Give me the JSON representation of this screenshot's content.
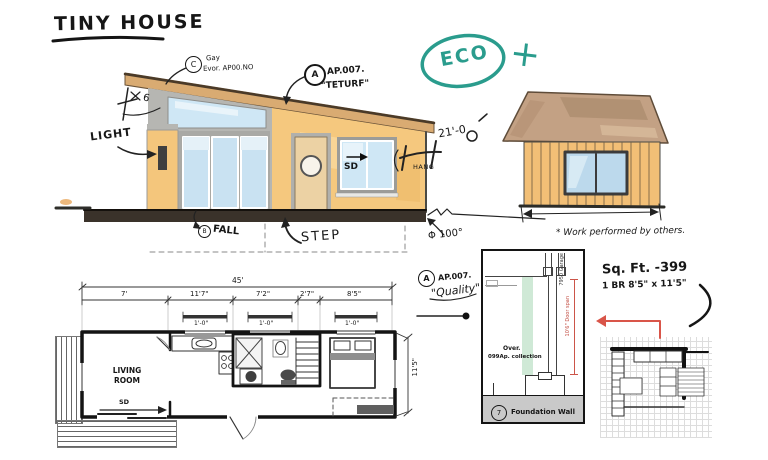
{
  "title": "TINY HOUSE",
  "eco": {
    "label": "ECO",
    "plus": "+"
  },
  "elevation": {
    "note_c": {
      "bubble": "C",
      "line1": "Gay",
      "line2": "Evor. AP00.NO"
    },
    "note_a": {
      "bubble": "A",
      "line1": "AP.007.",
      "line2": "\"TETURF\""
    },
    "light": "LIGHT",
    "slope_mark": "6",
    "fall_bubble": "B",
    "fall": "FALL",
    "step": "STEP",
    "sd": "SD",
    "hang": "HANG",
    "height": "21'-0",
    "angle": "Φ 100°"
  },
  "gable": {
    "note": "* Work performed by others."
  },
  "stats": {
    "sqft": "Sq. Ft.  -399",
    "bed": "1 BR 8'5\" x 11'5\""
  },
  "callout": {
    "bubble": "A",
    "line1": "AP.007.",
    "line2": "\"Quality\""
  },
  "detail": {
    "num": "7",
    "caption": "Foundation Wall",
    "over": "Over.",
    "collection": "099Ap. collection",
    "garage": "7950 Garage",
    "span": "10'6\" Door span"
  },
  "plan": {
    "total": "45'",
    "segments": [
      "7'",
      "11'7\"",
      "7'2\"",
      "2'7\"",
      "8'5\""
    ],
    "window_marks": [
      "1'-0\"",
      "1'-0\"",
      "1'-0\""
    ],
    "side": "11'5\"",
    "room": "LIVING ROOM",
    "sd": "SD"
  }
}
